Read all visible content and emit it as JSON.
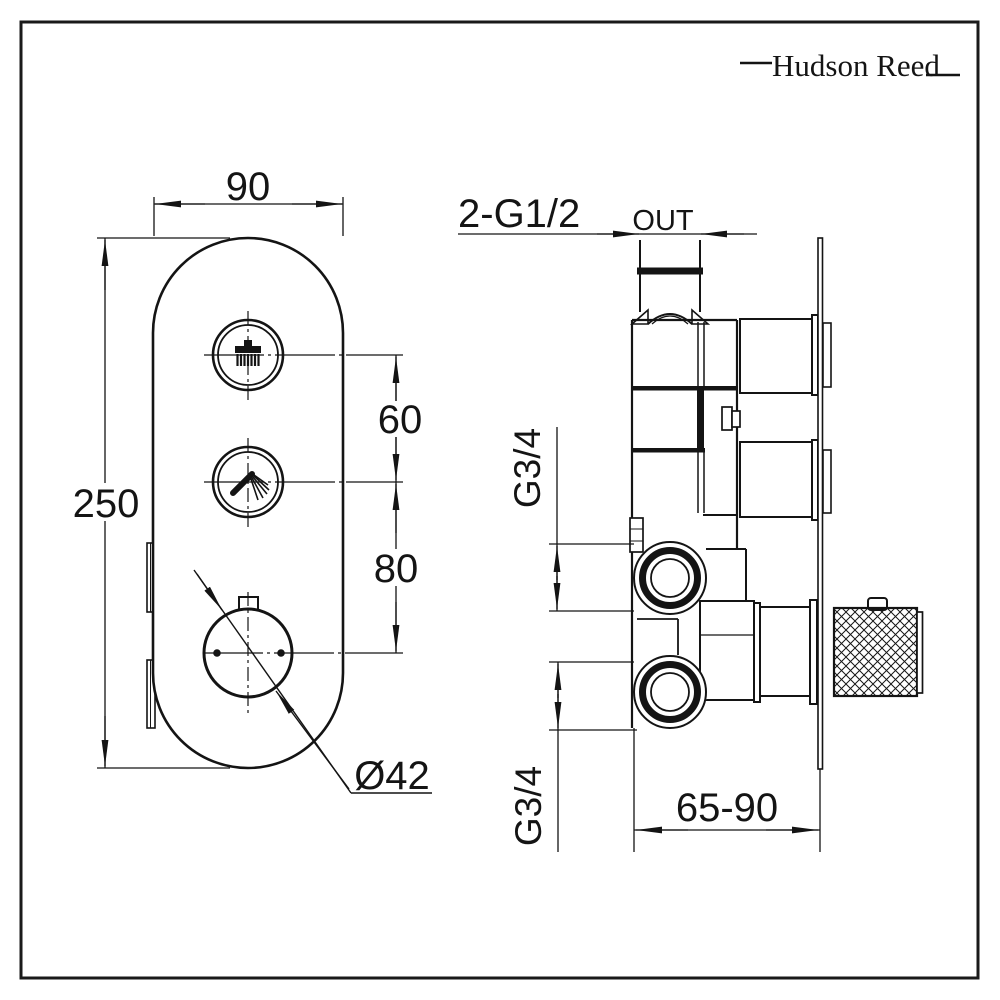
{
  "brand": {
    "logo_text": "Hudson Reed"
  },
  "front_view": {
    "dim_width": "90",
    "dim_height": "250",
    "dim_button_spacing": "60",
    "dim_dial_spacing": "80",
    "dim_dial_diameter": "Ø42"
  },
  "side_view": {
    "dim_outlet_threads": "2-G1/2",
    "outlet_label": "OUT",
    "dim_inlet_top": "G3/4",
    "dim_inlet_bottom": "G3/4",
    "dim_depth_range": "65-90"
  }
}
